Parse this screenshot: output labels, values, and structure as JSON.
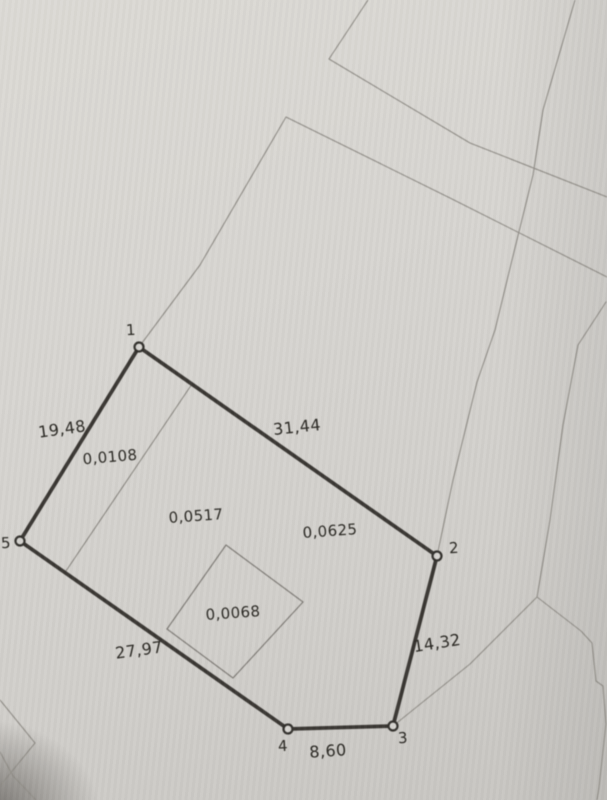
{
  "plan": {
    "vertex_labels": [
      "1",
      "2",
      "3",
      "4",
      "5"
    ],
    "edge_lengths": {
      "edge_5_1": "19,48",
      "edge_1_2": "31,44",
      "edge_2_3": "14,32",
      "edge_3_4": "8,60",
      "edge_4_5": "27,97"
    },
    "area_labels": {
      "left_strip": "0,0108",
      "main_part": "0,0517",
      "total_parcel": "0,0625",
      "building": "0,0068"
    },
    "colors": {
      "paper": "#d5d3cf",
      "parcel_boundary": "#3a3733",
      "faint_line": "#8f8c86",
      "text": "#2a2823"
    }
  }
}
